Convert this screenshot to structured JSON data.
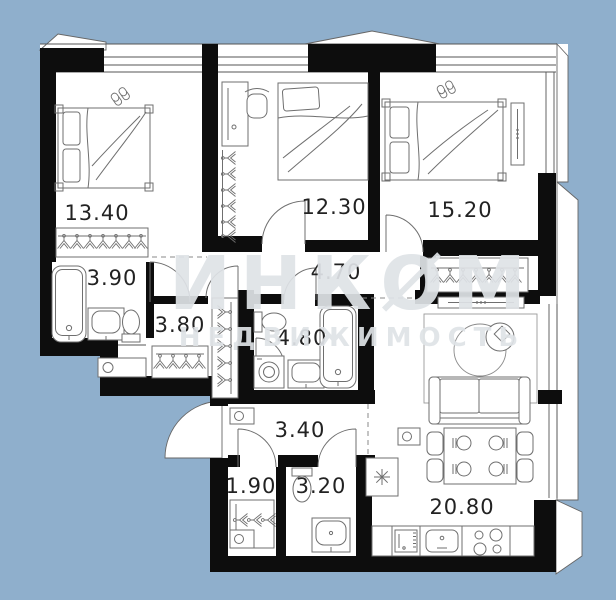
{
  "plan": {
    "watermark": {
      "line1": "ИНКØМ",
      "line2": "НЕДВИЖИМОСТЬ"
    },
    "rooms": [
      {
        "id": "bedroom-1",
        "area": "13.40"
      },
      {
        "id": "bedroom-2",
        "area": "12.30"
      },
      {
        "id": "bedroom-3",
        "area": "15.20"
      },
      {
        "id": "bathroom-1",
        "area": "3.90"
      },
      {
        "id": "corridor",
        "area": "4.70"
      },
      {
        "id": "wardrobe-hall",
        "area": "3.80"
      },
      {
        "id": "bathroom-2",
        "area": "4.80"
      },
      {
        "id": "entry-hall",
        "area": "3.40"
      },
      {
        "id": "storage",
        "area": "1.90"
      },
      {
        "id": "wc",
        "area": "3.20"
      },
      {
        "id": "kitchen-living",
        "area": "20.80"
      }
    ],
    "colors": {
      "outside": "#8fafcc",
      "wall": "#0d0d0d",
      "furniture_line": "#6f6f6f",
      "watermark": "#dfe3e7",
      "label": "#222222"
    }
  }
}
